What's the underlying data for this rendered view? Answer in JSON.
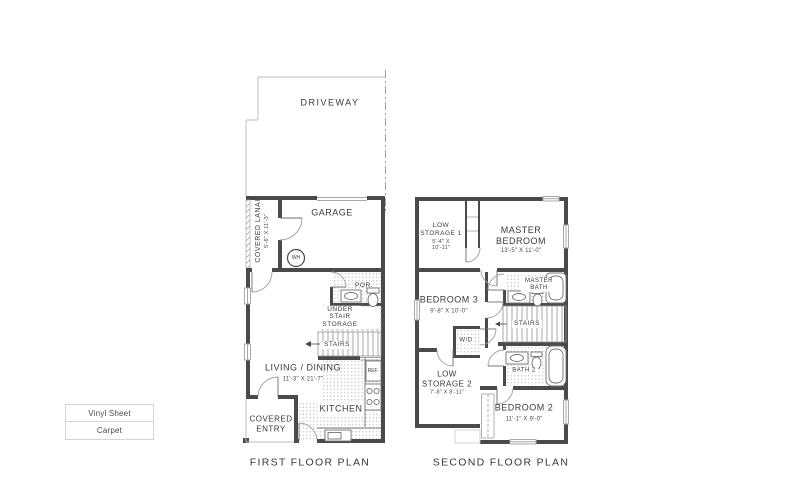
{
  "colors": {
    "wall": "#4a4a4a",
    "thin_line": "#9aa0a3",
    "text": "#3a3a3c"
  },
  "first_floor": {
    "caption": "FIRST FLOOR PLAN",
    "driveway": "DRIVEWAY",
    "garage": "GARAGE",
    "water_heater": "WH",
    "covered_lanai": {
      "name": "COVERED LANAI",
      "dims": "5'-6\" X 11'-3\""
    },
    "living_dining": {
      "name": "LIVING / DINING",
      "dims": "11'-3\" X 21'-7\""
    },
    "kitchen": "KITCHEN",
    "refrigerator": "REF.",
    "powder_room": "POR.",
    "under_stair_storage": "UNDER STAIR STORAGE",
    "stairs": "STAIRS",
    "covered_entry": "COVERED ENTRY"
  },
  "second_floor": {
    "caption": "SECOND FLOOR PLAN",
    "low_storage_1": {
      "name": "LOW STORAGE 1",
      "dims": "5'-4\" X 10'-11\""
    },
    "master_bedroom": {
      "name": "MASTER BEDROOM",
      "dims": "13'-5\" X 11'-0\""
    },
    "bedroom_3": {
      "name": "BEDROOM 3",
      "dims": "9'-8\" X 10'-0\""
    },
    "master_bath": "MASTER BATH",
    "stairs": "STAIRS",
    "washer_dryer": "W/D",
    "low_storage_2": {
      "name": "LOW STORAGE 2",
      "dims": "7'-8\" X 8'-11\""
    },
    "bath_2": "BATH 2",
    "bedroom_2": {
      "name": "BEDROOM 2",
      "dims": "11'-1\" X 9'-0\""
    }
  },
  "legend": {
    "vinyl": "Vinyl Sheet",
    "carpet": "Carpet"
  }
}
